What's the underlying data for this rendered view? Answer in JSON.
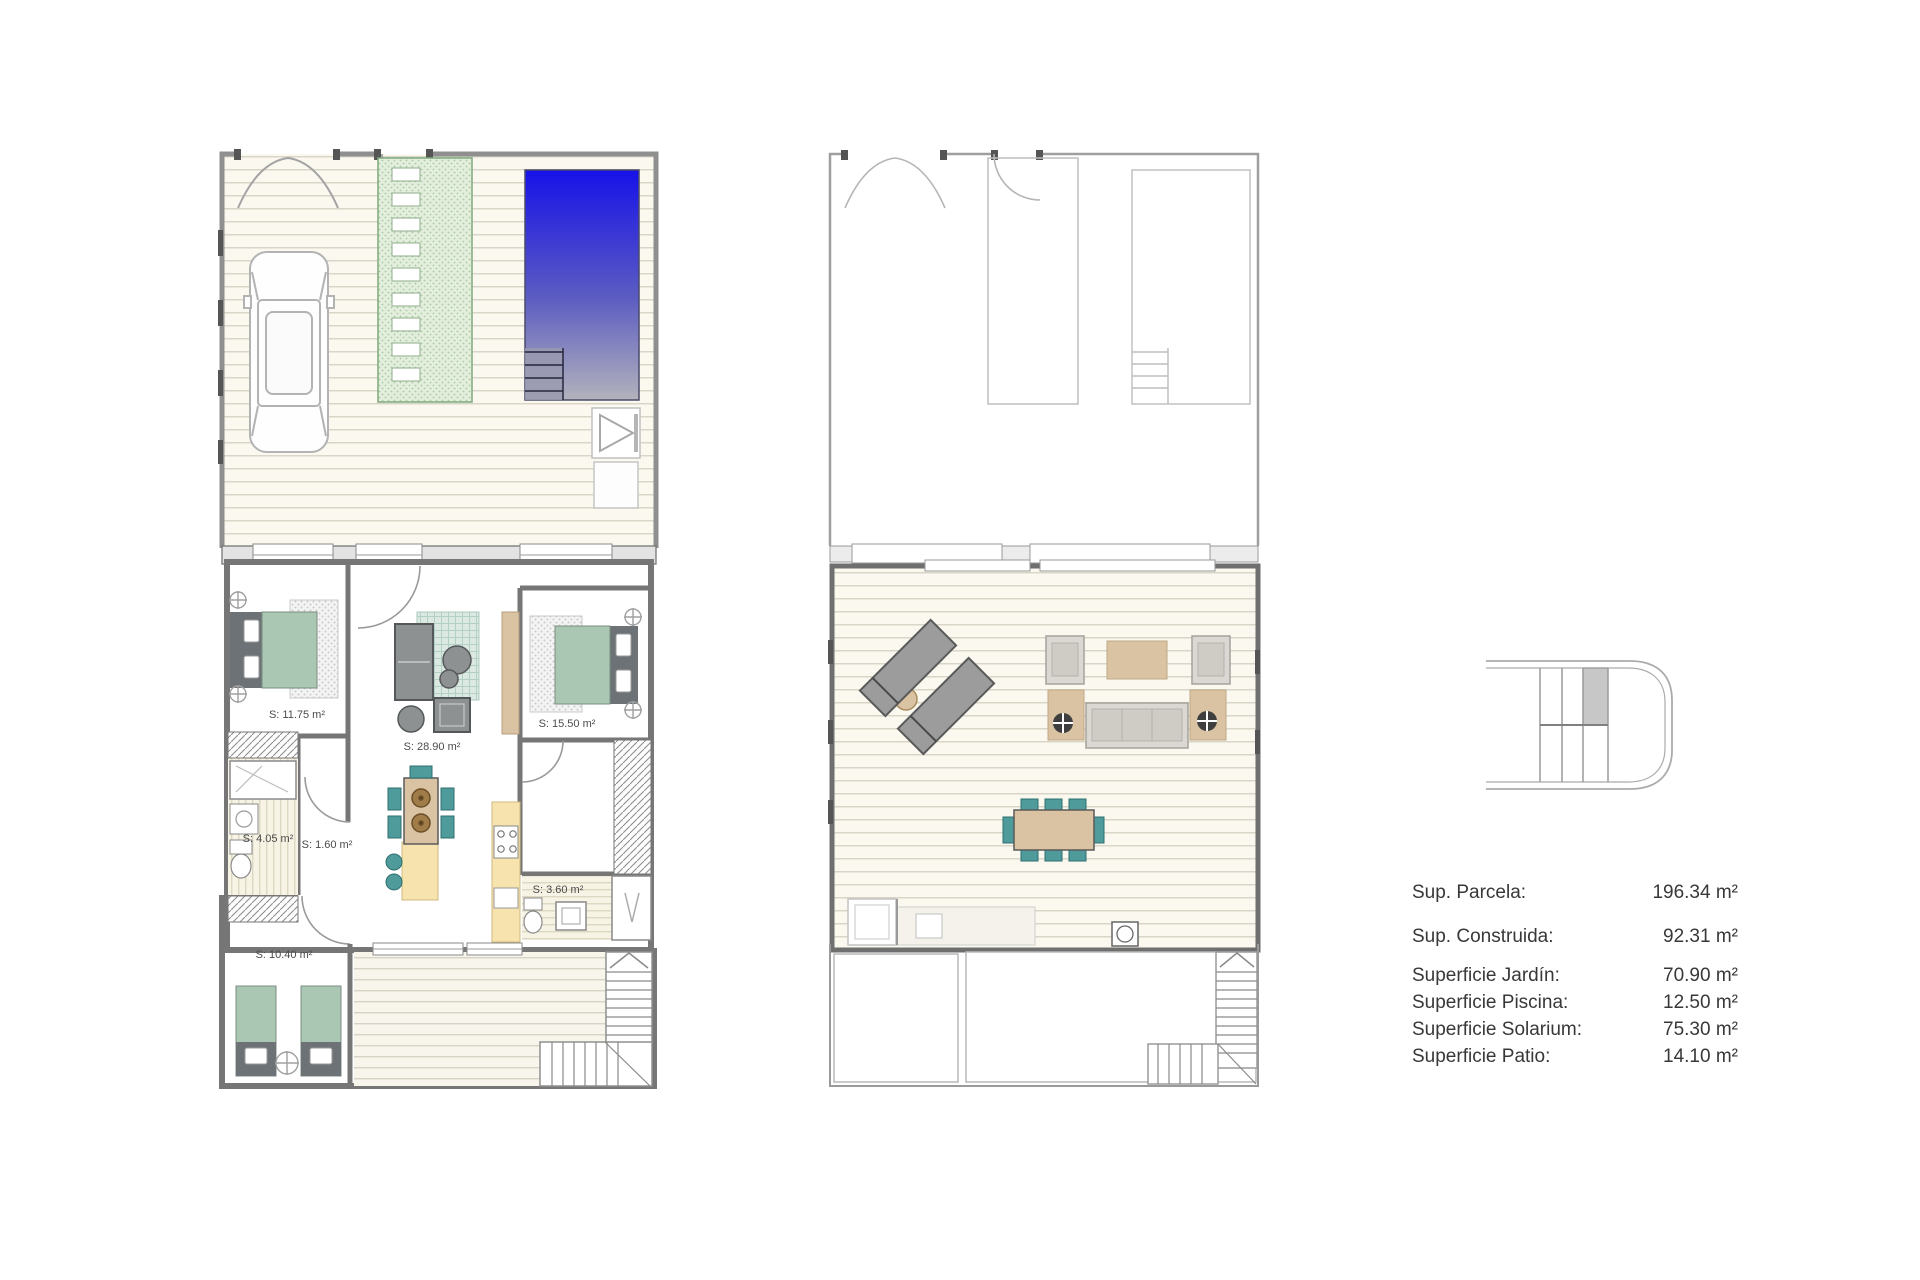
{
  "legend": {
    "rows": [
      {
        "label": "Sup. Parcela:",
        "value": "196.34 m²"
      },
      {
        "label": "Sup. Construida:",
        "value": "92.31 m²"
      },
      {
        "label": "Superficie Jardín:",
        "value": "70.90 m²"
      },
      {
        "label": "Superficie Piscina:",
        "value": "12.50 m²"
      },
      {
        "label": "Superficie Solarium:",
        "value": "75.30 m²"
      },
      {
        "label": "Superficie Patio:",
        "value": "14.10 m²"
      }
    ]
  },
  "ground_floor": {
    "room_labels": {
      "bedroom_1": "S: 11.75 m²",
      "living_kitchen": "S: 28.90 m²",
      "bedroom_2": "S: 15.50 m²",
      "bathroom_1": "S: 4.05 m²",
      "hall": "S: 1.60 m²",
      "bathroom_2": "S: 3.60 m²",
      "bedroom_3": "S: 10.40 m²"
    }
  },
  "colors": {
    "pool_top": "#1712e8",
    "pool_mid": "#5b5bc2",
    "pool_bottom": "#b2b2bc",
    "bed_green": "#a9c7b3",
    "chair_teal": "#4f9b9b",
    "wood_tan": "#d9c3a2",
    "kitchen_yellow": "#f6e3ae",
    "garden_path_green": "#e3eedd",
    "deck_cream": "#faf8ef"
  }
}
